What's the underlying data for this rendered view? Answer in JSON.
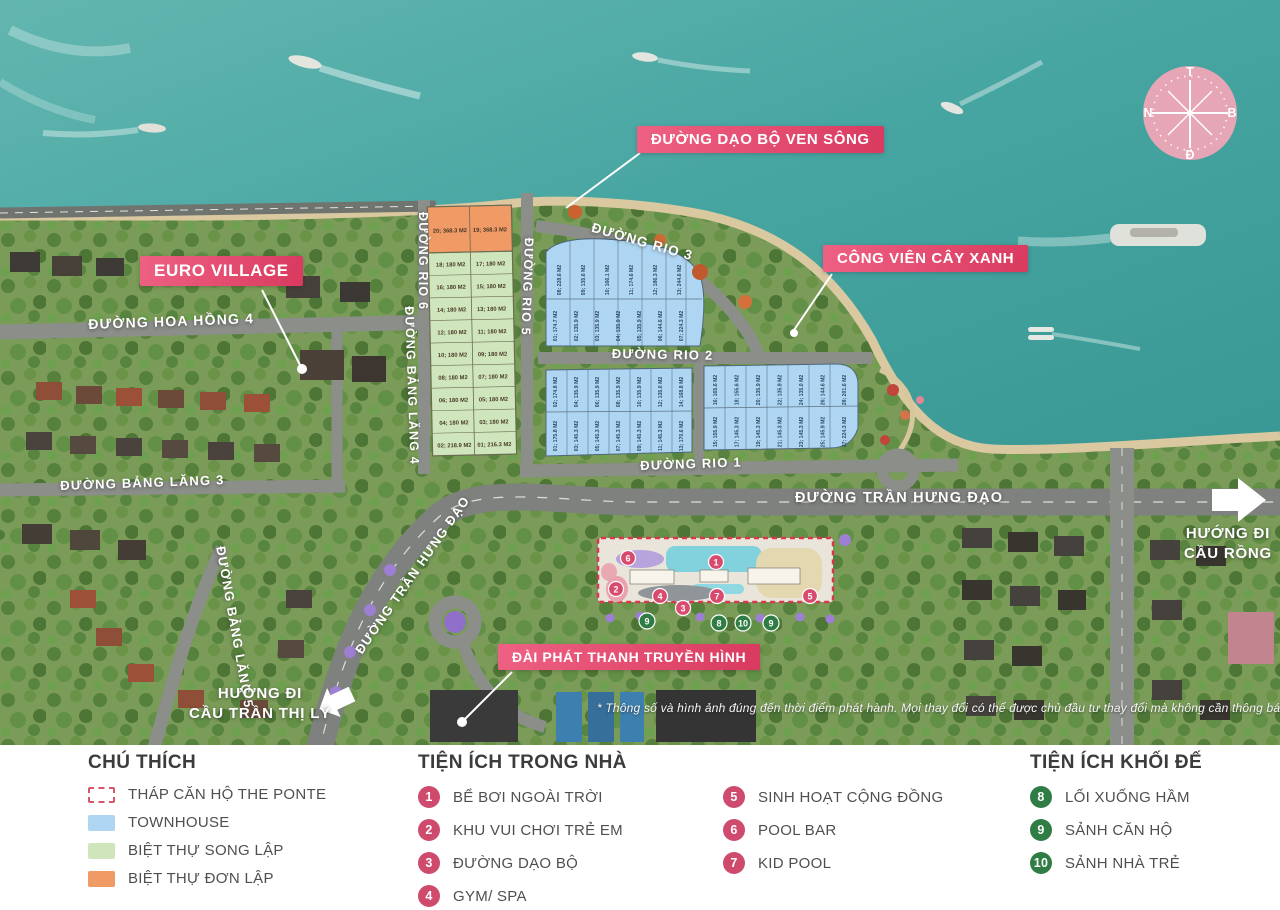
{
  "callouts": {
    "walkway": "ĐƯỜNG DẠO BỘ VEN SÔNG",
    "park": "CÔNG VIÊN CÂY XANH",
    "euro_village": "EURO VILLAGE",
    "radio_station": "ĐÀI PHÁT THANH TRUYỀN HÌNH"
  },
  "roads": {
    "hoa_hong_4": "ĐƯỜNG HOA HỒNG 4",
    "bang_lang_3": "ĐƯỜNG BẢNG LĂNG 3",
    "bang_lang_4": "ĐƯỜNG BẢNG LĂNG 4",
    "bang_lang_5": "ĐƯỜNG BẢNG LĂNG 5",
    "rio_1": "ĐƯỜNG RIO 1",
    "rio_2": "ĐƯỜNG RIO 2",
    "rio_3": "ĐƯỜNG RIO 3",
    "rio_5": "ĐƯỜNG RIO 5",
    "rio_6": "ĐƯỜNG RIO 6",
    "tran_hung_dao_west": "ĐƯỜNG TRẦN HƯNG ĐẠO",
    "tran_hung_dao_east": "ĐƯỜNG TRẦN HƯNG ĐẠO"
  },
  "directions": {
    "dragon_bridge": [
      "HƯỚNG ĐI",
      "CẦU RỒNG"
    ],
    "tran_thi_ly_bridge": [
      "HƯỚNG ĐI",
      "CẦU TRẦN THỊ LÝ"
    ]
  },
  "compass": {
    "top": "T",
    "right": "B",
    "bottom": "Đ",
    "left": "N"
  },
  "disclaimer": "* Thông số và hình ảnh đúng đến thời điểm phát hành. Mọi thay đổi có thể được chủ đầu tư thay đổi mà không cần thông báo",
  "tower_markers": {
    "pink": [
      "1",
      "2",
      "3",
      "4",
      "5",
      "6",
      "7"
    ],
    "green_row": [
      "9",
      "8",
      "10",
      "9"
    ]
  },
  "lots": {
    "villa_left": [
      "20; 368.3 M2",
      "18; 180 M2",
      "16; 180 M2",
      "14; 180 M2",
      "12; 180 M2",
      "10; 180 M2",
      "08; 180 M2",
      "06; 180 M2",
      "04; 180 M2",
      "02; 218.9 M2"
    ],
    "villa_right": [
      "19; 368.3 M2",
      "17; 180 M2",
      "15; 180 M2",
      "13; 180 M2",
      "11; 180 M2",
      "09; 180 M2",
      "07; 180 M2",
      "05; 180 M2",
      "03; 180 M2",
      "01; 216.3 M2"
    ],
    "town_a_top": [
      "08; 228.6 M2",
      "09; 135.6 M2",
      "10; 166.1 M2",
      "11; 174.6 M2",
      "12; 186.3 M2",
      "13; 244.6 M2"
    ],
    "town_a_bottom": [
      "01; 174.7 M2",
      "02; 135.9 M2",
      "03; 135.9 M2",
      "04; 135.9 M2",
      "05; 135.9 M2",
      "06; 144.6 M2",
      "07; 224.3 M2"
    ],
    "town_b_top": [
      "02; 174.8 M2",
      "04; 135.9 M2",
      "06; 135.9 M2",
      "08; 135.9 M2",
      "10; 135.9 M2",
      "12; 135.0 M2",
      "14; 168.8 M2"
    ],
    "town_b_bottom": [
      "01; 175.8 M2",
      "03; 145.3 M2",
      "05; 145.3 M2",
      "07; 145.3 M2",
      "09; 145.3 M2",
      "11; 145.3 M2",
      "13; 170.6 M2"
    ],
    "town_c_top": [
      "16; 165.6 M2",
      "18; 155.6 M2",
      "20; 135.9 M2",
      "22; 135.9 M2",
      "24; 135.0 M2",
      "26; 144.6 M2",
      "28; 201.6 M2"
    ],
    "town_c_bottom": [
      "15; 155.9 M2",
      "17; 145.3 M2",
      "19; 145.3 M2",
      "21; 145.3 M2",
      "23; 145.3 M2",
      "25; 145.9 M2",
      "27; 224.3 M2"
    ]
  },
  "legend": {
    "chu_thich": {
      "title": "CHÚ THÍCH",
      "items": [
        {
          "label": "THÁP CĂN HỘ THE PONTE",
          "swatch": "dashed-red"
        },
        {
          "label": "TOWNHOUSE",
          "swatch": "#aed6f2"
        },
        {
          "label": "BIỆT THỰ SONG LẬP",
          "swatch": "#cfe6bc"
        },
        {
          "label": "BIỆT THỰ ĐƠN LẬP",
          "swatch": "#f09a66"
        }
      ]
    },
    "indoor": {
      "title": "TIỆN ÍCH TRONG NHÀ",
      "items": [
        {
          "num": "1",
          "label": "BỂ BƠI NGOÀI TRỜI"
        },
        {
          "num": "2",
          "label": "KHU VUI CHƠI TRẺ EM"
        },
        {
          "num": "3",
          "label": "ĐƯỜNG DẠO BỘ"
        },
        {
          "num": "4",
          "label": "GYM/ SPA"
        },
        {
          "num": "5",
          "label": "SINH HOẠT CỘNG ĐỒNG"
        },
        {
          "num": "6",
          "label": "POOL BAR"
        },
        {
          "num": "7",
          "label": "KID POOL"
        }
      ]
    },
    "podium": {
      "title": "TIỆN ÍCH KHỐI ĐẾ",
      "items": [
        {
          "num": "8",
          "label": "LỐI XUỐNG HẦM"
        },
        {
          "num": "9",
          "label": "SẢNH CĂN HỘ"
        },
        {
          "num": "10",
          "label": "SẢNH NHÀ TRẺ"
        }
      ]
    }
  },
  "colors": {
    "accent_pink": "#d93a5f",
    "legend_pink_badge": "#cf4b6e",
    "legend_green_badge": "#2f7d44",
    "townhouse": "#aed6f2",
    "villa_song_lap": "#cfe6bc",
    "villa_don_lap": "#f09a66",
    "tower_outline": "#d8374f",
    "water": "#45a4a0"
  }
}
